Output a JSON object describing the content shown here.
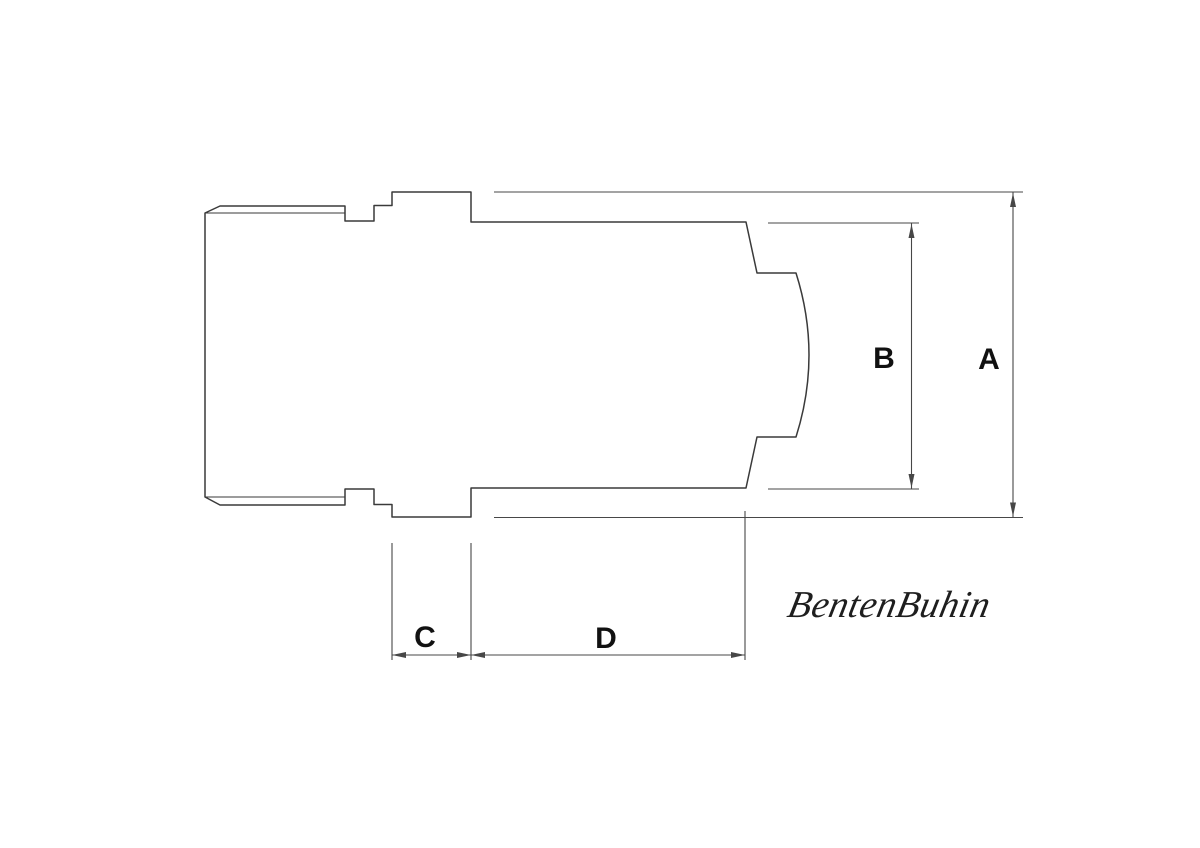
{
  "drawing": {
    "dimension_labels": {
      "a": "A",
      "b": "B",
      "c": "C",
      "d": "D"
    },
    "watermark": "BentenBuhin",
    "colors": {
      "background": "#ffffff",
      "part_line": "#3a3a3a",
      "dimension_line": "#474747",
      "label": "#111111",
      "signature": "#1e1e1e"
    }
  }
}
